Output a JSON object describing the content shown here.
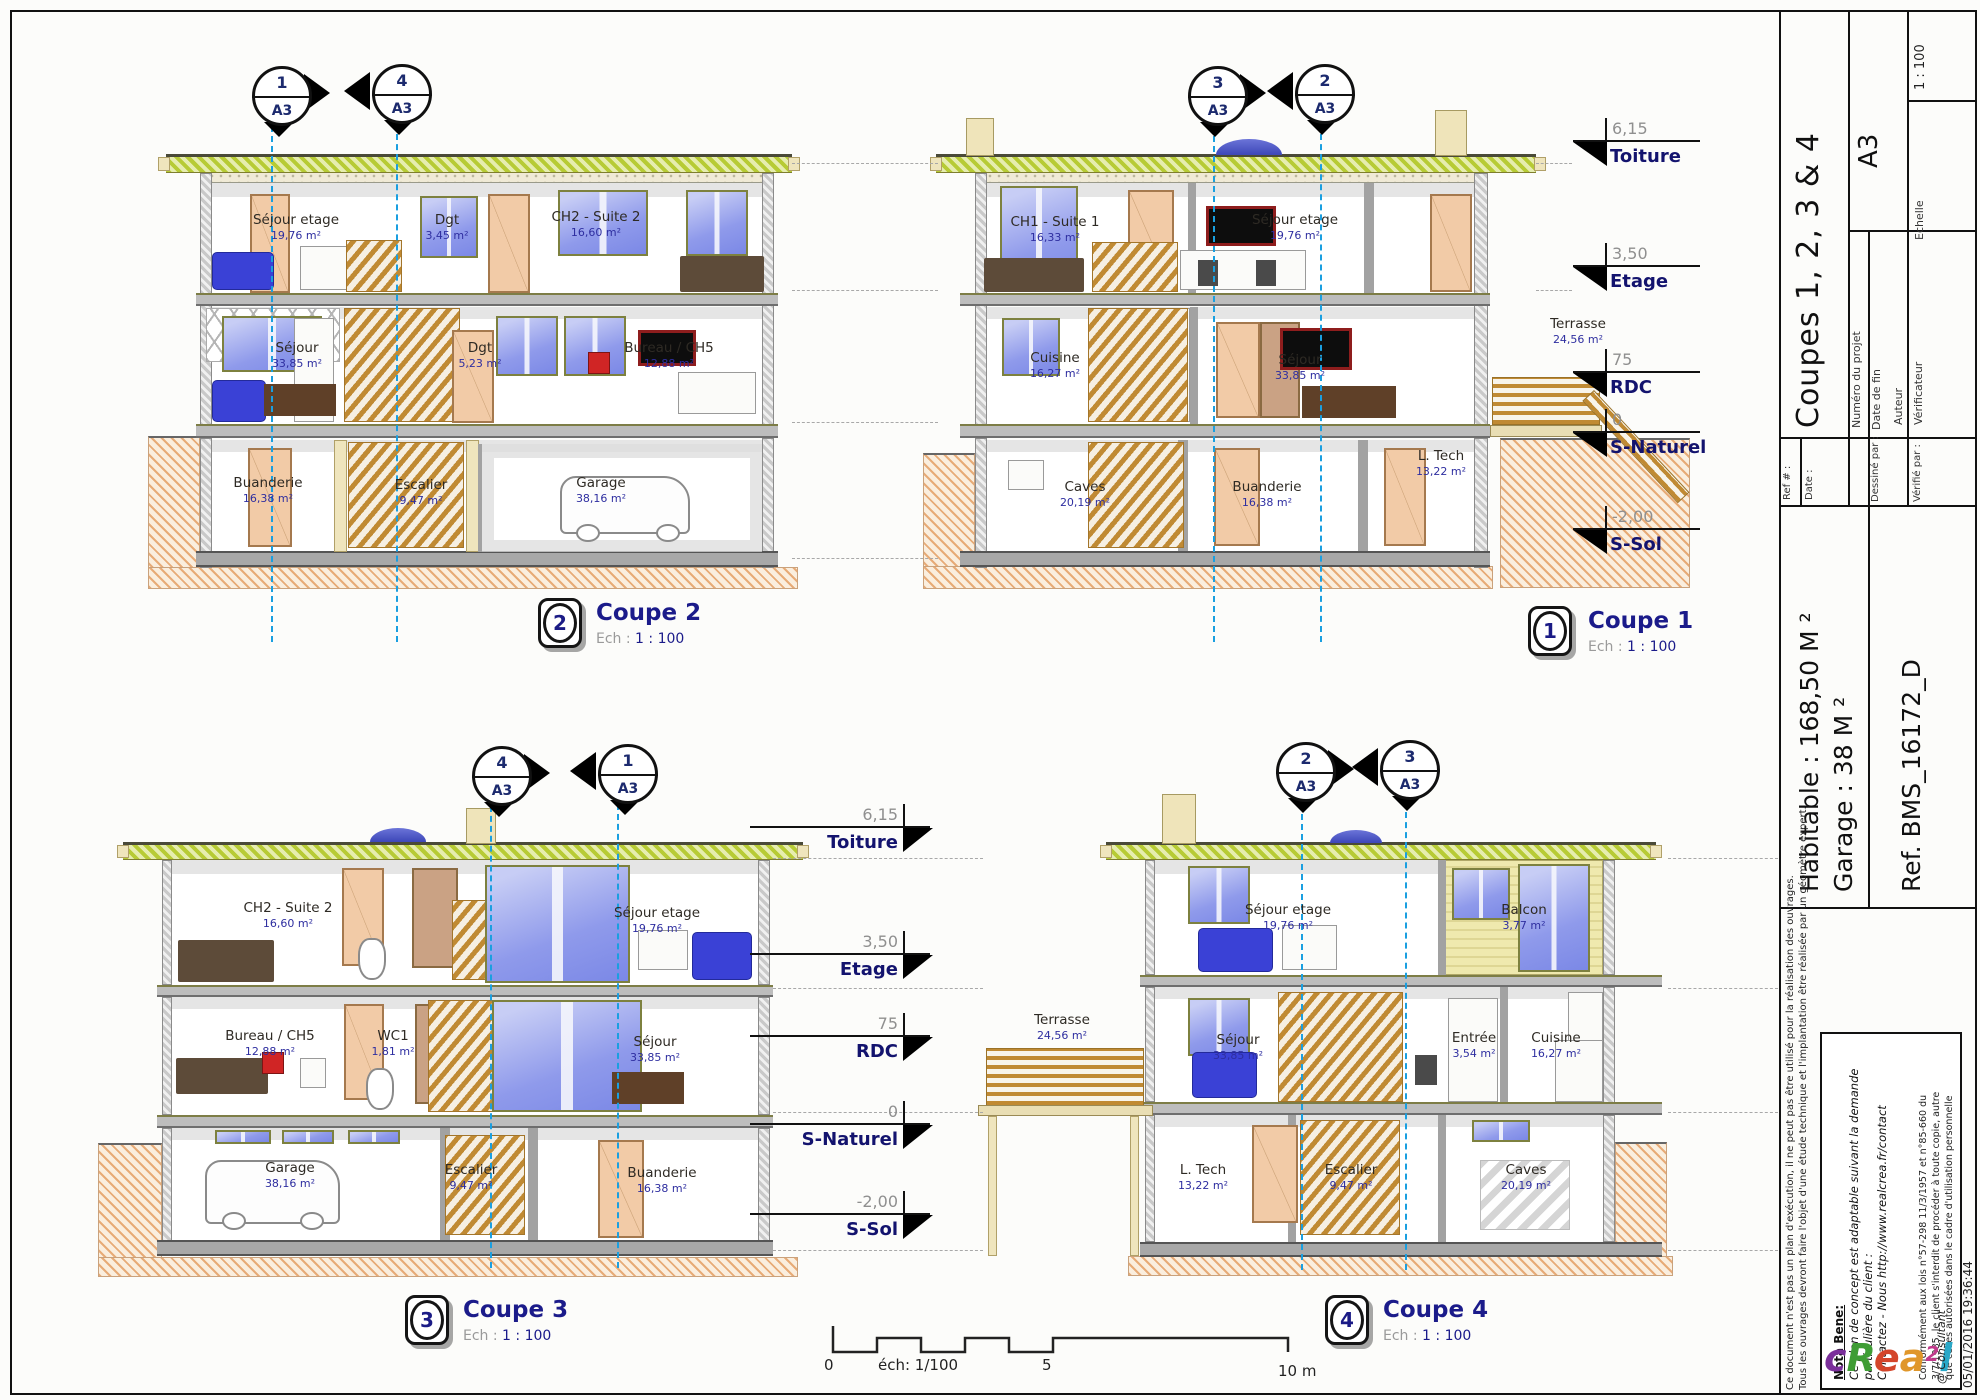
{
  "palette": {
    "accent_navy": "#1b1b8a",
    "section_line_blue": "#1a9fe0",
    "roof_green": "#b7cb35",
    "earth_tan": "#e7ab77",
    "window_blue": "#8f9aeb",
    "door_peach": "#f2cba7"
  },
  "scalebar": {
    "zero": "0",
    "ech": "éch: 1/100",
    "five": "5",
    "ten": "10 m"
  },
  "levels_right": [
    {
      "value": "6,15",
      "label": "Toiture"
    },
    {
      "value": "3,50",
      "label": "Etage"
    },
    {
      "value": "75",
      "label": "RDC"
    },
    {
      "value": "0",
      "label": "S-Naturel"
    },
    {
      "value": "-2,00",
      "label": "S-Sol"
    }
  ],
  "levels_mid": [
    {
      "value": "6,15",
      "label": "Toiture"
    },
    {
      "value": "3,50",
      "label": "Etage"
    },
    {
      "value": "75",
      "label": "RDC"
    },
    {
      "value": "0",
      "label": "S-Naturel"
    },
    {
      "value": "-2,00",
      "label": "S-Sol"
    }
  ],
  "terrasse": {
    "name": "Terrasse",
    "area": "24,56 m²"
  },
  "coupes": {
    "c1": {
      "badge": "1",
      "title": "Coupe 1",
      "ech_label": "Ech :",
      "ech_value": "1 : 100",
      "marker_a": {
        "num": "3",
        "sheet": "A3"
      },
      "marker_b": {
        "num": "2",
        "sheet": "A3"
      },
      "rooms": {
        "ch1": {
          "name": "CH1 - Suite 1",
          "area": "16,33 m²"
        },
        "sejour_etage": {
          "name": "Séjour etage",
          "area": "19,76 m²"
        },
        "cuisine": {
          "name": "Cuisine",
          "area": "16,27 m²"
        },
        "sejour": {
          "name": "Séjour",
          "area": "33,85 m²"
        },
        "caves": {
          "name": "Caves",
          "area": "20,19 m²"
        },
        "buanderie": {
          "name": "Buanderie",
          "area": "16,38 m²"
        },
        "ltech": {
          "name": "L. Tech",
          "area": "13,22 m²"
        }
      }
    },
    "c2": {
      "badge": "2",
      "title": "Coupe 2",
      "ech_label": "Ech :",
      "ech_value": "1 : 100",
      "marker_a": {
        "num": "1",
        "sheet": "A3"
      },
      "marker_b": {
        "num": "4",
        "sheet": "A3"
      },
      "rooms": {
        "sejour_etage": {
          "name": "Séjour etage",
          "area": "19,76 m²"
        },
        "dgt_etage": {
          "name": "Dgt",
          "area": "3,45 m²"
        },
        "ch2": {
          "name": "CH2 - Suite 2",
          "area": "16,60 m²"
        },
        "sejour": {
          "name": "Séjour",
          "area": "33,85 m²"
        },
        "dgt_rdc": {
          "name": "Dgt",
          "area": "5,23 m²"
        },
        "bureau": {
          "name": "Bureau / CH5",
          "area": "12,88 m²"
        },
        "buanderie": {
          "name": "Buanderie",
          "area": "16,38 m²"
        },
        "escalier": {
          "name": "Escalier",
          "area": "9,47 m²"
        },
        "garage": {
          "name": "Garage",
          "area": "38,16 m²"
        }
      }
    },
    "c3": {
      "badge": "3",
      "title": "Coupe 3",
      "ech_label": "Ech :",
      "ech_value": "1 : 100",
      "marker_a": {
        "num": "4",
        "sheet": "A3"
      },
      "marker_b": {
        "num": "1",
        "sheet": "A3"
      },
      "rooms": {
        "ch2": {
          "name": "CH2 - Suite 2",
          "area": "16,60 m²"
        },
        "sejour_etage": {
          "name": "Séjour etage",
          "area": "19,76 m²"
        },
        "bureau": {
          "name": "Bureau / CH5",
          "area": "12,88 m²"
        },
        "wc1": {
          "name": "WC1",
          "area": "1,81 m²"
        },
        "sejour": {
          "name": "Séjour",
          "area": "33,85 m²"
        },
        "garage": {
          "name": "Garage",
          "area": "38,16 m²"
        },
        "escalier": {
          "name": "Escalier",
          "area": "9,47 m²"
        },
        "buanderie": {
          "name": "Buanderie",
          "area": "16,38 m²"
        }
      }
    },
    "c4": {
      "badge": "4",
      "title": "Coupe 4",
      "ech_label": "Ech :",
      "ech_value": "1 : 100",
      "marker_a": {
        "num": "2",
        "sheet": "A3"
      },
      "marker_b": {
        "num": "3",
        "sheet": "A3"
      },
      "rooms": {
        "sejour_etage": {
          "name": "Séjour etage",
          "area": "19,76 m²"
        },
        "balcon": {
          "name": "Balcon",
          "area": "3,77 m²"
        },
        "sejour": {
          "name": "Séjour",
          "area": "33,85 m²"
        },
        "entree": {
          "name": "Entrée",
          "area": "3,54 m²"
        },
        "cuisine": {
          "name": "Cuisine",
          "area": "16,27 m²"
        },
        "ltech": {
          "name": "L. Tech",
          "area": "13,22 m²"
        },
        "escalier": {
          "name": "Escalier",
          "area": "9,47 m²"
        },
        "caves": {
          "name": "Caves",
          "area": "20,19 m²"
        }
      }
    }
  },
  "titleblock": {
    "title": "Coupes 1, 2, 3 & 4",
    "paper": "A3",
    "scale": "1 : 100",
    "echelle": "Echelle",
    "numero": "Numéro du projet",
    "datefin": "Date de fin",
    "auteur": "Auteur",
    "verificateur": "Vérificateur",
    "ref_label": "Ref # :",
    "date_label": "Date :",
    "dessine_label": "Dessiné par :",
    "verifie_label": "Vérifié par :",
    "habitable": "Habitable : 168,50 M ²",
    "garage": "Garage : 38 M ²",
    "refdoc": "Ref. BMS_16172_D",
    "note1": "Ce document n'est pas un plan d'exécution, il ne peut pas être utilisé pour la réalisation des ouvrages.",
    "note2": "Tous les ouvrages devront faire l'objet d'une étude technique et l'implantation être réalisée par un géomètre expert.",
    "nota_title": "Nota Bene:",
    "nota1": "Ce plan de concept est adaptable suivant la demande",
    "nota2": "particulière du client :",
    "nota3": "Contactez - Nous http://www.realcrea.fr/contact",
    "legal1": "Conformément aux lois n°57-298 11/3/1957 et n°85-660 du",
    "legal2": "3/7/1985, le client s'interdit de procéder à toute copie, autre",
    "legal3": "que celles autorisées dans le cadre d'utilisation personnelle",
    "logo": {
      "c": "c",
      "r": "R",
      "e": "e",
      "a": "a",
      "two": "2",
      "l": "l"
    },
    "logo_sub": "@ Consultant",
    "datetime": "05/01/2016 19:36:44"
  }
}
